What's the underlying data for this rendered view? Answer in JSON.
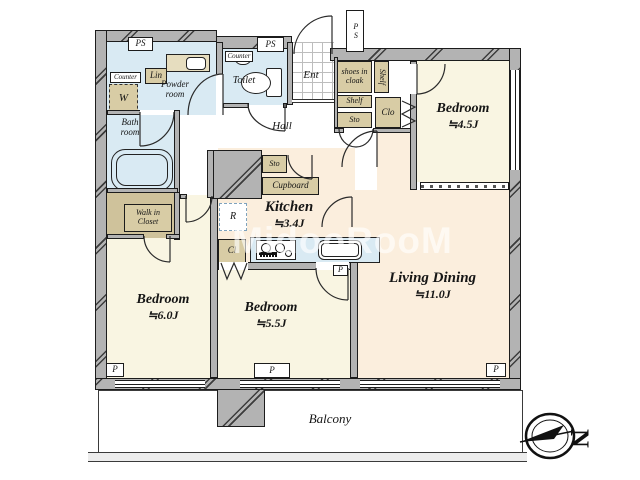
{
  "watermark": "MidooRooM",
  "rooms": {
    "powder_room": {
      "name": "Powder\nroom"
    },
    "bath_room": {
      "name": "Bath\nroom"
    },
    "toilet": {
      "name": "Toilet"
    },
    "ent": {
      "name": "Ent"
    },
    "hall": {
      "name": "Hall"
    },
    "shoes_in_cloak": {
      "name": "shoes in\ncloak"
    },
    "bedroom_45": {
      "name": "Bedroom",
      "area": "≒4.5J"
    },
    "kitchen": {
      "name": "Kitchen",
      "area": "≒3.4J"
    },
    "living_dining": {
      "name": "Living Dining",
      "area": "≒11.0J"
    },
    "bedroom_60": {
      "name": "Bedroom",
      "area": "≒6.0J"
    },
    "bedroom_55": {
      "name": "Bedroom",
      "area": "≒5.5J"
    },
    "walk_in_closet": {
      "name": "Walk in\nCloset"
    },
    "balcony": {
      "name": "Balcony"
    }
  },
  "storage": {
    "lin": "Lin",
    "counter_powder": "Counter",
    "counter_toilet": "Counter",
    "w": "W",
    "shelf_vertical": "Shelf",
    "shelf": "Shelf",
    "sto_entry": "Sto",
    "clo": "Clo",
    "sto_kitchen": "Sto",
    "cupboard": "Cupboard",
    "r": "R",
    "cl": "Cl"
  },
  "labels": {
    "ps": "PS",
    "p": "P",
    "compass_north": "N"
  },
  "colors": {
    "room_cream": "#f9f5e2",
    "room_peach": "#fbeedd",
    "water_blue": "#d9eaf3",
    "storage_tan": "#d8cca5",
    "wall_gray": "#b3b3b3"
  }
}
